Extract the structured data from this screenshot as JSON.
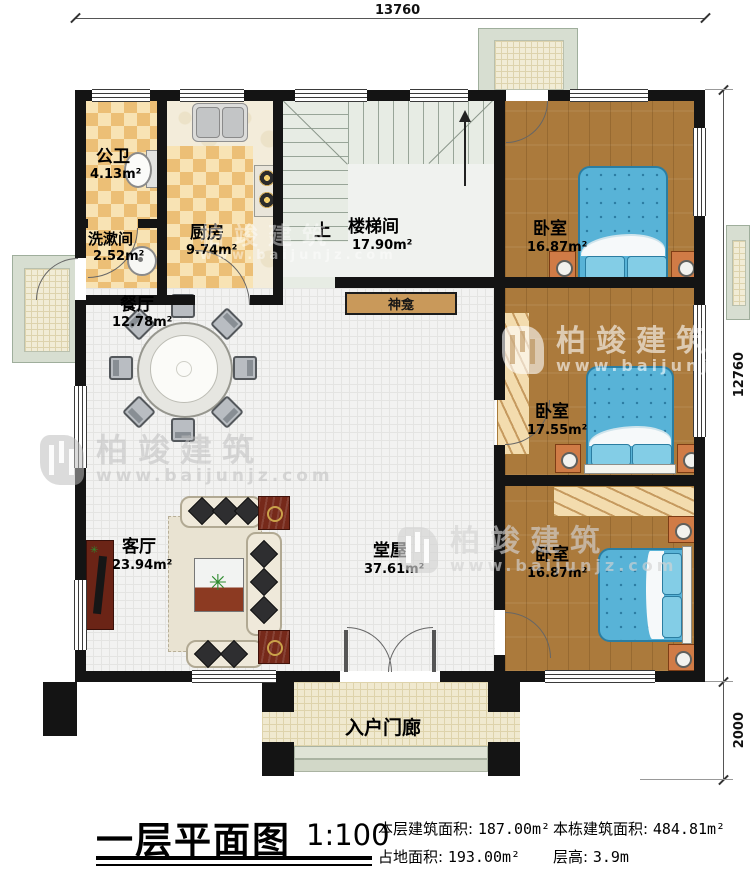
{
  "drawing": {
    "type": "floor-plan",
    "dimensions": {
      "width": "13760",
      "height": "12760",
      "porch_depth": "2000"
    },
    "rooms": {
      "public_bath": {
        "name": "公卫",
        "area": "4.13m²"
      },
      "washroom": {
        "name": "洗漱间",
        "area": "2.52m²"
      },
      "kitchen": {
        "name": "厨房",
        "area": "9.74m²"
      },
      "stairwell": {
        "name": "楼梯间",
        "area": "17.90m²"
      },
      "bedroom_top": {
        "name": "卧室",
        "area": "16.87m²"
      },
      "dining": {
        "name": "餐厅",
        "area": "12.78m²"
      },
      "bedroom_mid": {
        "name": "卧室",
        "area": "17.55m²"
      },
      "living": {
        "name": "客厅",
        "area": "23.94m²"
      },
      "hall": {
        "name": "堂屋",
        "area": "37.61m²"
      },
      "bedroom_bottom": {
        "name": "卧室",
        "area": "16.87m²"
      },
      "entry_porch": {
        "name": "入户门廊"
      }
    },
    "annotations": {
      "up": "上",
      "shrine": "神龛"
    },
    "watermark": {
      "brand": "柏竣建筑",
      "url": "www.baijunjz.com"
    },
    "title_block": {
      "title": "一层平面图",
      "scale": "1:100",
      "stats": [
        {
          "label": "本层建筑面积:",
          "value": "187.00m²"
        },
        {
          "label": "本栋建筑面积:",
          "value": "484.81m²"
        },
        {
          "label": "占地面积:",
          "value": "193.00m²"
        },
        {
          "label": "层高:",
          "value": "3.9m"
        }
      ]
    },
    "colors": {
      "wall": "#141414",
      "wood_floor": "#ab7a3c",
      "bed_blue": "#58b3d7",
      "tile": "#f8e3b4",
      "furniture_accent": "#d07b46"
    }
  }
}
